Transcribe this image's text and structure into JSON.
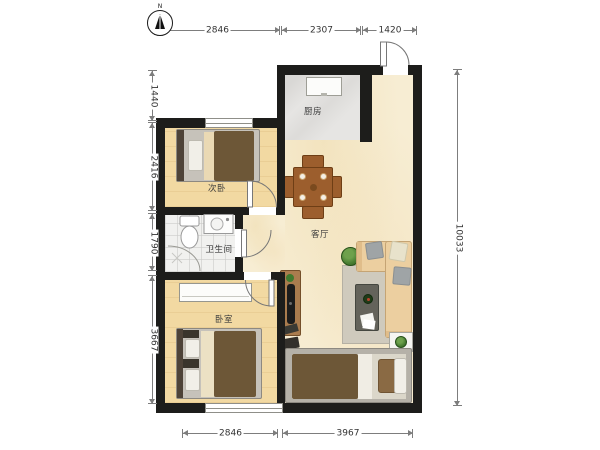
{
  "plan": {
    "compass": {
      "label": "N"
    },
    "rooms": {
      "kitchen": {
        "label": "厨房"
      },
      "second_bedroom": {
        "label": "次卧"
      },
      "bathroom": {
        "label": "卫生间"
      },
      "living_room": {
        "label": "客厅"
      },
      "bedroom": {
        "label": "卧室"
      }
    },
    "dimensions_mm": {
      "top": [
        "2846",
        "2307",
        "1420"
      ],
      "left": [
        "1440",
        "2416",
        "1790",
        "3667"
      ],
      "right": [
        "10033"
      ],
      "bottom": [
        "2846",
        "3967"
      ]
    },
    "colors": {
      "wall": "#1d1d1b",
      "wood_floor": "#f2d9a2",
      "living_floor": "#f7edd3",
      "kitchen_floor": "#e6e5e3",
      "bath_floor": "#f1f1ef",
      "furniture_wood": "#9c5e2d",
      "sofa": "#eccfa0",
      "blanket": "#6d5737",
      "dimension_line": "#7d7d7d"
    }
  }
}
